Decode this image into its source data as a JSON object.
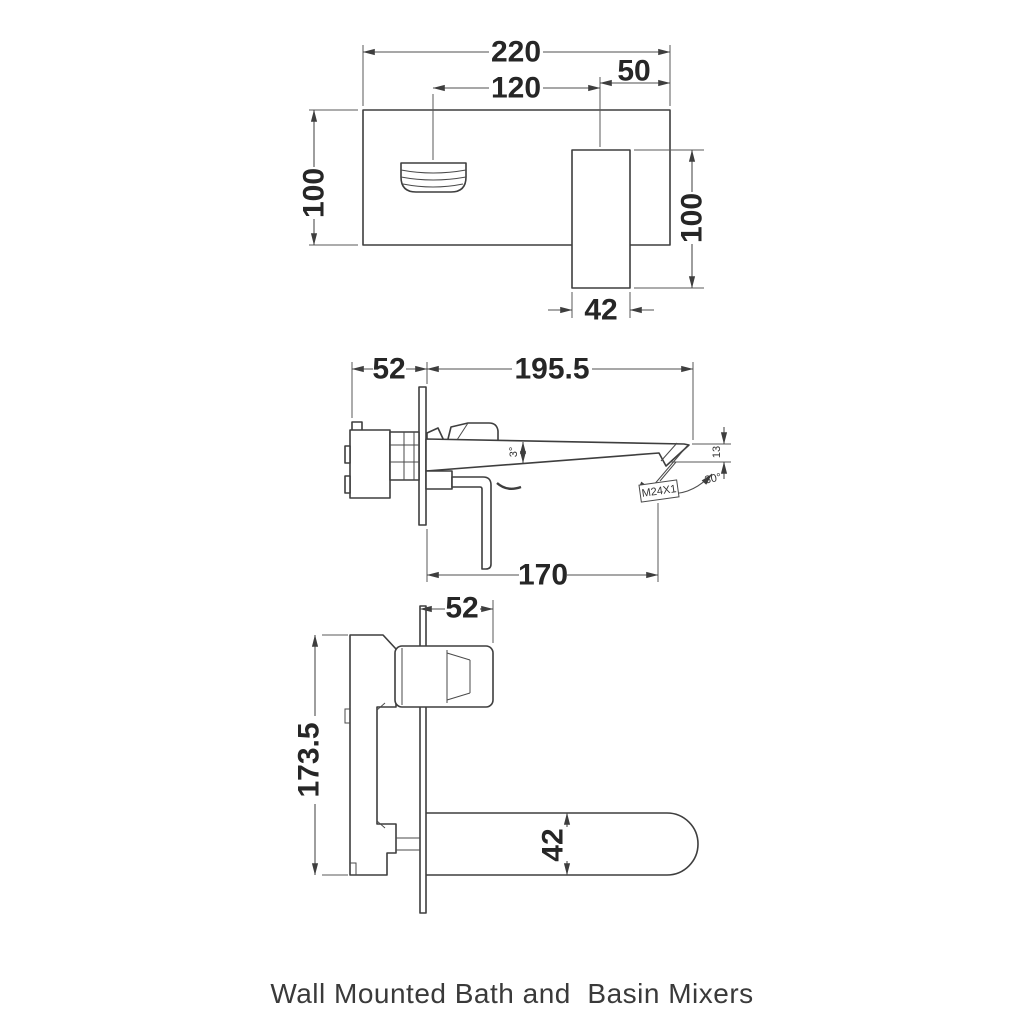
{
  "caption": "Wall Mounted Bath and  Basin Mixers",
  "colors": {
    "line": "#3e3e3e",
    "dim_line": "#4f4f4f",
    "text": "#262626",
    "background": "#ffffff"
  },
  "views": {
    "front": {
      "title": "basin-mixer-front-view",
      "dims": {
        "plate_width": "220",
        "handle_center": "120",
        "spout_center": "50",
        "plate_height": "100",
        "spout_length": "100",
        "spout_width": "42"
      }
    },
    "basin_side": {
      "title": "basin-mixer-side-view",
      "dims": {
        "concealed_depth": "52",
        "spout_reach": "195.5",
        "spout_taper": "3°",
        "aerator_thread": "M24X1",
        "tip_angle": "30°",
        "tip_depth": "13",
        "aerator_center": "170"
      }
    },
    "bath_side": {
      "title": "bath-mixer-side-view",
      "dims": {
        "concealed_depth": "52",
        "body_height": "173.5",
        "spout_depth": "42"
      }
    }
  }
}
